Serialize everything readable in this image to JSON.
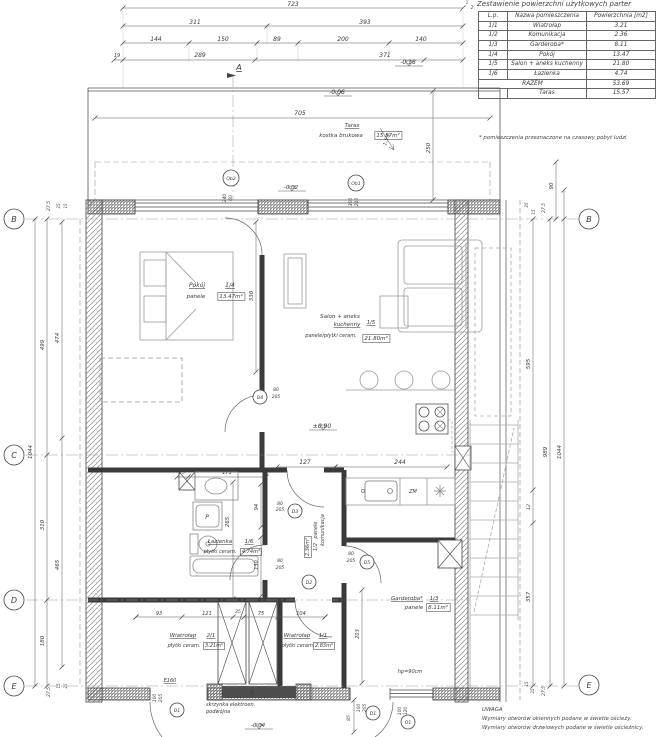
{
  "title": "Zestawienie powierzchni użytkowych parter",
  "table": {
    "headers": [
      "L.p.",
      "Nazwa pomieszczenia",
      "Powierzchnia [m2]"
    ],
    "rows": [
      {
        "lp": "1/1",
        "name": "Wiatrołap",
        "area": "3.21"
      },
      {
        "lp": "1/2",
        "name": "Komunikacja",
        "area": "2.36"
      },
      {
        "lp": "1/3",
        "name": "Garderoba*",
        "area": "8.11"
      },
      {
        "lp": "1/4",
        "name": "Pokój",
        "area": "13.47"
      },
      {
        "lp": "1/5",
        "name": "Salon + aneks kuchenny",
        "area": "21.80"
      },
      {
        "lp": "1/6",
        "name": "Łazienka",
        "area": "4.74"
      }
    ],
    "razem_label": "RAZEM",
    "razem": "53.69",
    "taras_label": "Taras",
    "taras": "15.57",
    "footnote": "* pomieszczenia przeznaczone na czasowy pobyt ludzi"
  },
  "notes": {
    "heading": "UWAGA",
    "line1": "Wymiary otworów okiennych podane w świetle ościeży.",
    "line2": "Wymiary otworów drzwiowych podane w świetle ościeżnicy."
  },
  "plan": {
    "texts": [
      {
        "t": "723",
        "x": 293,
        "y": 6
      },
      {
        "t": "311",
        "x": 195,
        "y": 24
      },
      {
        "t": "393",
        "x": 365,
        "y": 24
      },
      {
        "t": "144",
        "x": 156,
        "y": 41
      },
      {
        "t": "150",
        "x": 223,
        "y": 41
      },
      {
        "t": "89",
        "x": 277,
        "y": 41
      },
      {
        "t": "200",
        "x": 343,
        "y": 41
      },
      {
        "t": "140",
        "x": 421,
        "y": 41
      },
      {
        "t": "19",
        "x": 117,
        "y": 57,
        "s": 5
      },
      {
        "t": "289",
        "x": 200,
        "y": 57
      },
      {
        "t": "371",
        "x": 385,
        "y": 57
      },
      {
        "t": "A",
        "x": 239,
        "y": 70,
        "s": 8,
        "u": 1
      },
      {
        "t": "705",
        "x": 300,
        "y": 115
      },
      {
        "t": "-0.06",
        "x": 337,
        "y": 94,
        "f": 1
      },
      {
        "t": "-0.18",
        "x": 408,
        "y": 64,
        "f": 1
      },
      {
        "t": "-0.02",
        "x": 291,
        "y": 189,
        "f": 1,
        "s": 5.5
      },
      {
        "t": "Taras",
        "x": 352,
        "y": 127,
        "u": 1,
        "s": 5.5,
        "n": "room-label"
      },
      {
        "t": "kostka brukowa",
        "x": 341,
        "y": 137,
        "s": 5.5
      },
      {
        "t": "15.57m²",
        "x": 388,
        "y": 137,
        "s": 5.5,
        "b": 1
      },
      {
        "t": "1.5%",
        "x": 388,
        "y": 140,
        "r": -72,
        "s": 5
      },
      {
        "t": "250",
        "x": 430,
        "y": 148,
        "r": -90,
        "s": 5.5
      },
      {
        "t": "240",
        "x": 226,
        "y": 198,
        "r": -90,
        "s": 4.5
      },
      {
        "t": "60",
        "x": 232,
        "y": 198,
        "r": -90,
        "s": 4.5
      },
      {
        "t": "300",
        "x": 352,
        "y": 202,
        "r": -90,
        "s": 4.5
      },
      {
        "t": "210",
        "x": 358,
        "y": 202,
        "r": -90,
        "s": 4.5
      },
      {
        "t": "27.5",
        "x": 50,
        "y": 206,
        "r": -90,
        "s": 4.5
      },
      {
        "t": "25",
        "x": 60,
        "y": 206,
        "r": -90,
        "s": 4
      },
      {
        "t": "15",
        "x": 67,
        "y": 206,
        "r": -90,
        "s": 4
      },
      {
        "t": "499",
        "x": 44,
        "y": 345,
        "r": -90,
        "s": 5.5
      },
      {
        "t": "474",
        "x": 59,
        "y": 338,
        "r": -90,
        "s": 5.5
      },
      {
        "t": "1044",
        "x": 32,
        "y": 452,
        "r": -90,
        "s": 5.5
      },
      {
        "t": "310",
        "x": 44,
        "y": 525,
        "r": -90,
        "s": 5.5
      },
      {
        "t": "465",
        "x": 59,
        "y": 565,
        "r": -90,
        "s": 5.5
      },
      {
        "t": "180",
        "x": 44,
        "y": 641,
        "r": -90,
        "s": 5.5
      },
      {
        "t": "27.5",
        "x": 50,
        "y": 692,
        "r": -90,
        "s": 4.5
      },
      {
        "t": "15",
        "x": 60,
        "y": 686,
        "r": -90,
        "s": 4
      },
      {
        "t": "25",
        "x": 67,
        "y": 686,
        "r": -90,
        "s": 4
      },
      {
        "t": "90",
        "x": 553,
        "y": 186,
        "r": -90,
        "s": 5.5
      },
      {
        "t": "27.5",
        "x": 545,
        "y": 208,
        "r": -90,
        "s": 4.5
      },
      {
        "t": "25",
        "x": 528,
        "y": 205,
        "r": -90,
        "s": 4
      },
      {
        "t": "15",
        "x": 535,
        "y": 212,
        "r": -90,
        "s": 4
      },
      {
        "t": "595",
        "x": 530,
        "y": 364,
        "r": -90,
        "s": 5.5
      },
      {
        "t": "989",
        "x": 547,
        "y": 452,
        "r": -90,
        "s": 5.5
      },
      {
        "t": "1044",
        "x": 561,
        "y": 452,
        "r": -90,
        "s": 5.5
      },
      {
        "t": "12",
        "x": 530,
        "y": 507,
        "r": -90,
        "s": 4.5
      },
      {
        "t": "357",
        "x": 530,
        "y": 597,
        "r": -90,
        "s": 5.5
      },
      {
        "t": "15",
        "x": 528,
        "y": 684,
        "r": -90,
        "s": 4
      },
      {
        "t": "25",
        "x": 534,
        "y": 691,
        "r": -90,
        "s": 4
      },
      {
        "t": "27.5",
        "x": 545,
        "y": 691,
        "r": -90,
        "s": 4.5
      },
      {
        "t": "Pokój",
        "x": 197,
        "y": 287,
        "u": 1,
        "n": "room-label"
      },
      {
        "t": "1/4",
        "x": 230,
        "y": 287,
        "u": 1
      },
      {
        "t": "panele",
        "x": 196,
        "y": 298,
        "s": 5.5
      },
      {
        "t": "13.47m²",
        "x": 231,
        "y": 298,
        "b": 1,
        "s": 5.5
      },
      {
        "t": "330",
        "x": 253,
        "y": 296,
        "r": -90,
        "s": 5.5
      },
      {
        "t": "Salon + aneks",
        "x": 340,
        "y": 318,
        "s": 5.5,
        "n": "room-label"
      },
      {
        "t": "kuchenny",
        "x": 347,
        "y": 326,
        "u": 1,
        "s": 5.5
      },
      {
        "t": "1/5",
        "x": 371,
        "y": 324,
        "u": 1,
        "s": 5.5
      },
      {
        "t": "panele/płytki ceram.",
        "x": 331,
        "y": 337,
        "s": 5
      },
      {
        "t": "21.80m²",
        "x": 376,
        "y": 340,
        "b": 1,
        "s": 5.5
      },
      {
        "t": "±0.00",
        "x": 322,
        "y": 428,
        "f": 1
      },
      {
        "t": "127",
        "x": 305,
        "y": 464
      },
      {
        "t": "244",
        "x": 400,
        "y": 464
      },
      {
        "t": "ZM",
        "x": 413,
        "y": 493,
        "s": 5,
        "c": "#8a8a8a"
      },
      {
        "t": "25",
        "x": 182,
        "y": 474,
        "s": 4.5
      },
      {
        "t": "171",
        "x": 227,
        "y": 474,
        "s": 5
      },
      {
        "t": "94",
        "x": 258,
        "y": 507,
        "r": -90,
        "s": 5
      },
      {
        "t": "265",
        "x": 229,
        "y": 522,
        "r": -90,
        "s": 5.5
      },
      {
        "t": "130",
        "x": 258,
        "y": 565,
        "r": -90,
        "s": 5
      },
      {
        "t": "Łazienka",
        "x": 220,
        "y": 543,
        "u": 1,
        "s": 5.5,
        "n": "room-label"
      },
      {
        "t": "1/6",
        "x": 249,
        "y": 543,
        "u": 1,
        "s": 5.5
      },
      {
        "t": "płytki ceram.",
        "x": 220,
        "y": 553,
        "s": 5
      },
      {
        "t": "4.74m²",
        "x": 251,
        "y": 553,
        "b": 1,
        "s": 5
      },
      {
        "t": "P",
        "x": 207,
        "y": 519,
        "s": 6,
        "c": "#9a9a9a"
      },
      {
        "t": "80",
        "x": 280,
        "y": 505,
        "s": 4.5
      },
      {
        "t": "205",
        "x": 280,
        "y": 511,
        "s": 4.5
      },
      {
        "t": "panele",
        "x": 317,
        "y": 530,
        "r": -90,
        "s": 5
      },
      {
        "t": "komunikacja",
        "x": 324,
        "y": 530,
        "r": -90,
        "s": 5
      },
      {
        "t": "2.36m²",
        "x": 309,
        "y": 547,
        "r": -90,
        "s": 5,
        "b": 1
      },
      {
        "t": "1/2",
        "x": 317,
        "y": 547,
        "r": -90,
        "s": 5
      },
      {
        "t": "80",
        "x": 276,
        "y": 391,
        "s": 4.5
      },
      {
        "t": "205",
        "x": 276,
        "y": 398,
        "s": 4.5
      },
      {
        "t": "80",
        "x": 351,
        "y": 555,
        "s": 4.5
      },
      {
        "t": "205",
        "x": 351,
        "y": 562,
        "s": 4.5
      },
      {
        "t": "80",
        "x": 280,
        "y": 562,
        "s": 4.5
      },
      {
        "t": "205",
        "x": 280,
        "y": 569,
        "s": 4.5
      },
      {
        "t": "Garderoba*",
        "x": 407,
        "y": 600,
        "u": 1,
        "s": 5.5,
        "n": "room-label"
      },
      {
        "t": "1/3",
        "x": 434,
        "y": 600,
        "u": 1,
        "s": 5.5
      },
      {
        "t": "panele",
        "x": 414,
        "y": 609,
        "s": 5.5
      },
      {
        "t": "8.11m²",
        "x": 438,
        "y": 609,
        "b": 1,
        "s": 5.5
      },
      {
        "t": "203",
        "x": 359,
        "y": 634,
        "r": -90,
        "s": 5
      },
      {
        "t": "hp=90cm",
        "x": 410,
        "y": 673,
        "s": 5
      },
      {
        "t": "93",
        "x": 159,
        "y": 615,
        "s": 5
      },
      {
        "t": "121",
        "x": 207,
        "y": 615,
        "s": 5
      },
      {
        "t": "25",
        "x": 238,
        "y": 613,
        "s": 4.5
      },
      {
        "t": "75",
        "x": 261,
        "y": 615,
        "s": 5
      },
      {
        "t": "104",
        "x": 301,
        "y": 615,
        "s": 5
      },
      {
        "t": "Wiatrołap",
        "x": 183,
        "y": 637,
        "u": 1,
        "s": 5.5,
        "n": "room-label"
      },
      {
        "t": "2/1",
        "x": 211,
        "y": 637,
        "u": 1,
        "s": 5.5
      },
      {
        "t": "płytki ceram.",
        "x": 184,
        "y": 647,
        "s": 5
      },
      {
        "t": "3.21m²",
        "x": 214,
        "y": 647,
        "b": 1,
        "s": 5
      },
      {
        "t": "Wiatrołap",
        "x": 297,
        "y": 637,
        "u": 1,
        "s": 5.5,
        "n": "room-label"
      },
      {
        "t": "1/1",
        "x": 323,
        "y": 637,
        "u": 1,
        "s": 5.5
      },
      {
        "t": "płytki ceram.",
        "x": 298,
        "y": 647,
        "s": 5
      },
      {
        "t": "2.83m²",
        "x": 324,
        "y": 647,
        "b": 1,
        "s": 5
      },
      {
        "t": "E160",
        "x": 170,
        "y": 682,
        "u": 1,
        "s": 5
      },
      {
        "t": "100",
        "x": 156,
        "y": 698,
        "r": -90,
        "s": 4.5
      },
      {
        "t": "205",
        "x": 162,
        "y": 698,
        "r": -90,
        "s": 4.5
      },
      {
        "t": "skrzynka elektroen.",
        "x": 206,
        "y": 706,
        "a": "s",
        "s": 5
      },
      {
        "t": "podwójna",
        "x": 206,
        "y": 713,
        "a": "s",
        "s": 5
      },
      {
        "t": "E",
        "x": 252,
        "y": 695,
        "s": 6,
        "c": "#dddddd"
      },
      {
        "t": "-0.04",
        "x": 258,
        "y": 727,
        "f": 1,
        "s": 5.5
      },
      {
        "t": "85",
        "x": 350,
        "y": 718,
        "r": -90,
        "s": 4.5
      },
      {
        "t": "100",
        "x": 360,
        "y": 708,
        "r": -90,
        "s": 4.5
      },
      {
        "t": "205",
        "x": 366,
        "y": 708,
        "r": -90,
        "s": 4.5
      },
      {
        "t": "100",
        "x": 401,
        "y": 711,
        "r": -90,
        "s": 4.5
      },
      {
        "t": "120",
        "x": 407,
        "y": 711,
        "r": -90,
        "s": 4.5
      },
      {
        "t": "1",
        "x": 467,
        "y": 4,
        "s": 4
      },
      {
        "t": "2",
        "x": 472,
        "y": 9,
        "s": 4
      }
    ],
    "markers": [
      {
        "l": "B",
        "x": 14,
        "y": 219,
        "r": 10
      },
      {
        "l": "C",
        "x": 14,
        "y": 455,
        "r": 10
      },
      {
        "l": "D",
        "x": 14,
        "y": 600,
        "r": 10
      },
      {
        "l": "E",
        "x": 14,
        "y": 686,
        "r": 10
      },
      {
        "l": "B",
        "x": 589,
        "y": 219,
        "r": 10
      },
      {
        "l": "E",
        "x": 589,
        "y": 685,
        "r": 10
      },
      {
        "l": "Ob2",
        "x": 231,
        "y": 178,
        "r": 8
      },
      {
        "l": "Ob1",
        "x": 356,
        "y": 183,
        "r": 8
      },
      {
        "l": "D4",
        "x": 260,
        "y": 397,
        "r": 7
      },
      {
        "l": "D3",
        "x": 295,
        "y": 511,
        "r": 7
      },
      {
        "l": "D2",
        "x": 309,
        "y": 582,
        "r": 7
      },
      {
        "l": "D5",
        "x": 367,
        "y": 562,
        "r": 7
      },
      {
        "l": "D1",
        "x": 177,
        "y": 710,
        "r": 7
      },
      {
        "l": "D1",
        "x": 373,
        "y": 713,
        "r": 7
      },
      {
        "l": "O1",
        "x": 408,
        "y": 722,
        "r": 7
      }
    ],
    "dims": [
      [
        123,
        8,
        463,
        8
      ],
      [
        123,
        26,
        463,
        26
      ],
      [
        123,
        43,
        463,
        43
      ],
      [
        114,
        60,
        463,
        60
      ],
      [
        95,
        118,
        490,
        118
      ],
      [
        35,
        219,
        35,
        686
      ],
      [
        47,
        219,
        47,
        686
      ],
      [
        62,
        222,
        62,
        667
      ],
      [
        533,
        219,
        533,
        686
      ],
      [
        550,
        219,
        550,
        686
      ],
      [
        564,
        190,
        564,
        686
      ],
      [
        556,
        162,
        556,
        219
      ],
      [
        433,
        91,
        433,
        200
      ],
      [
        256,
        222,
        256,
        372
      ],
      [
        177,
        477,
        266,
        477
      ],
      [
        233,
        482,
        233,
        599
      ],
      [
        261,
        484,
        261,
        527
      ],
      [
        261,
        537,
        261,
        596
      ],
      [
        277,
        467,
        335,
        467
      ],
      [
        335,
        467,
        447,
        467
      ],
      [
        136,
        617,
        325,
        617
      ],
      [
        362,
        590,
        362,
        683
      ],
      [
        354,
        700,
        354,
        732
      ]
    ],
    "ticks": [
      [
        267,
        26
      ],
      [
        189,
        43
      ],
      [
        257,
        43
      ],
      [
        298,
        43
      ],
      [
        389,
        43
      ],
      [
        123,
        60
      ],
      [
        255,
        60
      ],
      [
        424,
        60
      ],
      [
        47,
        455
      ],
      [
        47,
        600
      ],
      [
        62,
        438
      ],
      [
        533,
        490
      ],
      [
        533,
        523
      ],
      [
        188,
        477
      ],
      [
        136,
        617
      ],
      [
        182,
        617
      ],
      [
        233,
        617
      ],
      [
        244,
        617
      ],
      [
        278,
        617
      ],
      [
        325,
        617
      ],
      [
        564,
        219
      ]
    ]
  }
}
